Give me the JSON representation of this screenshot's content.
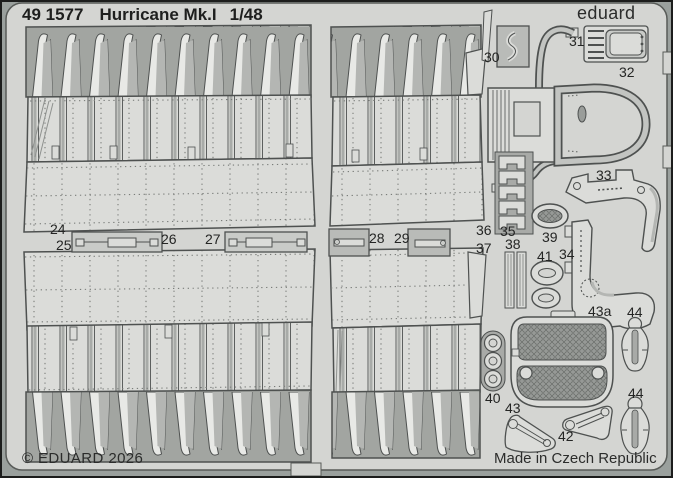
{
  "header": {
    "catalog_number": "49 1577",
    "title": "Hurricane Mk.I",
    "scale": "1/48"
  },
  "brand": "eduard",
  "footer": {
    "copyright": "© EDUARD 2026",
    "made_in": "Made in Czech Republic"
  },
  "labels": {
    "p24": "24",
    "p25": "25",
    "p26": "26",
    "p27": "27",
    "p28": "28",
    "p29": "29",
    "p30": "30",
    "p31": "31",
    "p32": "32",
    "p33": "33",
    "p34": "34",
    "p35": "35",
    "p36": "36",
    "p37": "37",
    "p38": "38",
    "p39": "39",
    "p40": "40",
    "p41": "41",
    "p42": "42",
    "p43": "43",
    "p43a": "43a",
    "p44a": "44",
    "p44b": "44"
  },
  "colors": {
    "background": "#9aa09d",
    "fret": "#d4d5d2",
    "cutout": "#a2a5a1",
    "part_light": "#dbdcd9",
    "part_mid": "#b9bbb8",
    "outline": "#4e5150",
    "text": "#242524"
  }
}
